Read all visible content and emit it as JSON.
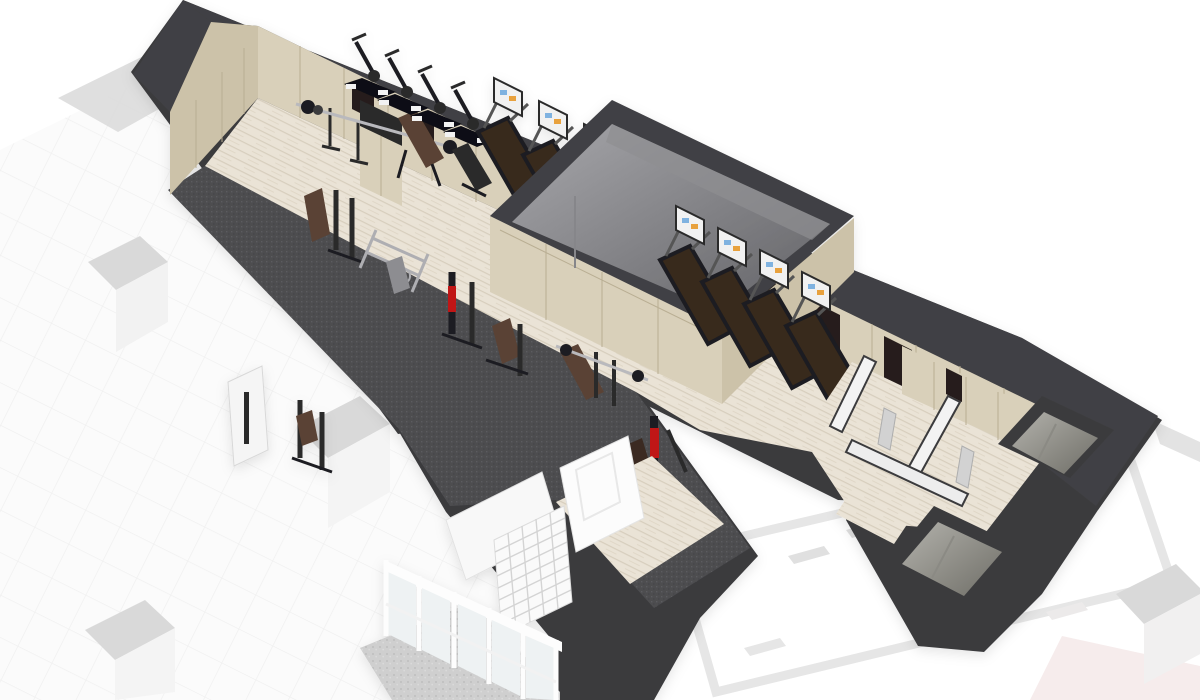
{
  "scene": {
    "type": "3d-isometric-floorplan-render",
    "subject": "fitness-center-gym-floor-plan",
    "description": "Cutaway axonometric render of a gym floor: wood floor, dark carpet strength zone, cardio rows, central enclosed service box, changing rooms and shafts at right, glass entry vestibule at bottom, faded adjacent spaces around"
  },
  "inventory": {
    "exercise_bikes": 4,
    "treadmills_row_upper": 3,
    "treadmills_row_lower": 4,
    "weight_benches": 3,
    "strength_machines": 7,
    "barbell_racks": 2,
    "freestanding_columns": 3,
    "service_shafts": 2,
    "entry_door_sets": 2,
    "shoe_cubby_units": 1
  },
  "colors": {
    "bg": "#ffffff",
    "wall": "#3b3b3e",
    "wallBand": "#414144",
    "woodFloor": "#eae3d6",
    "woodFloor2": "#e2dac9",
    "plank": "#d7cebd",
    "woodPanel": "#d9d0ba",
    "woodPanel2": "#ccc2a9",
    "panelSeam": "#b9ae93",
    "carpet": "#4d4d50",
    "carpetDot": "#5a5a5e",
    "boxHi": "#a7a7ab",
    "boxLo": "#626266",
    "boxEdge": "#2f2f31",
    "recess": "#261f1a",
    "belt": "#38291d",
    "beltFrame": "#1e1e20",
    "console": "#f1f1f1",
    "consoleDark": "#2a2a2c",
    "screenBlue": "#7fb2e0",
    "screenOrange": "#e8a13c",
    "metal": "#b9b9bd",
    "equip": "#2a2a2c",
    "benchBrown": "#5a4334",
    "accentRed": "#c01818",
    "whiteUnit": "#f5f5f5",
    "glass": "#eef2f3",
    "mullion": "#fdfdfd",
    "tile": "#cfcfcf",
    "concreteHi": "#aaa9a3",
    "concreteLo": "#77766f",
    "fadedFloor": "#fafafa",
    "fadedGrid": "#efefef",
    "fadedBlock": "#d9d9d9",
    "fadedLine": "#e3e3e3",
    "fadedWallLine": "#e8e8e8",
    "pinkTint": "#f6ecec",
    "shadow": "#00000014"
  }
}
